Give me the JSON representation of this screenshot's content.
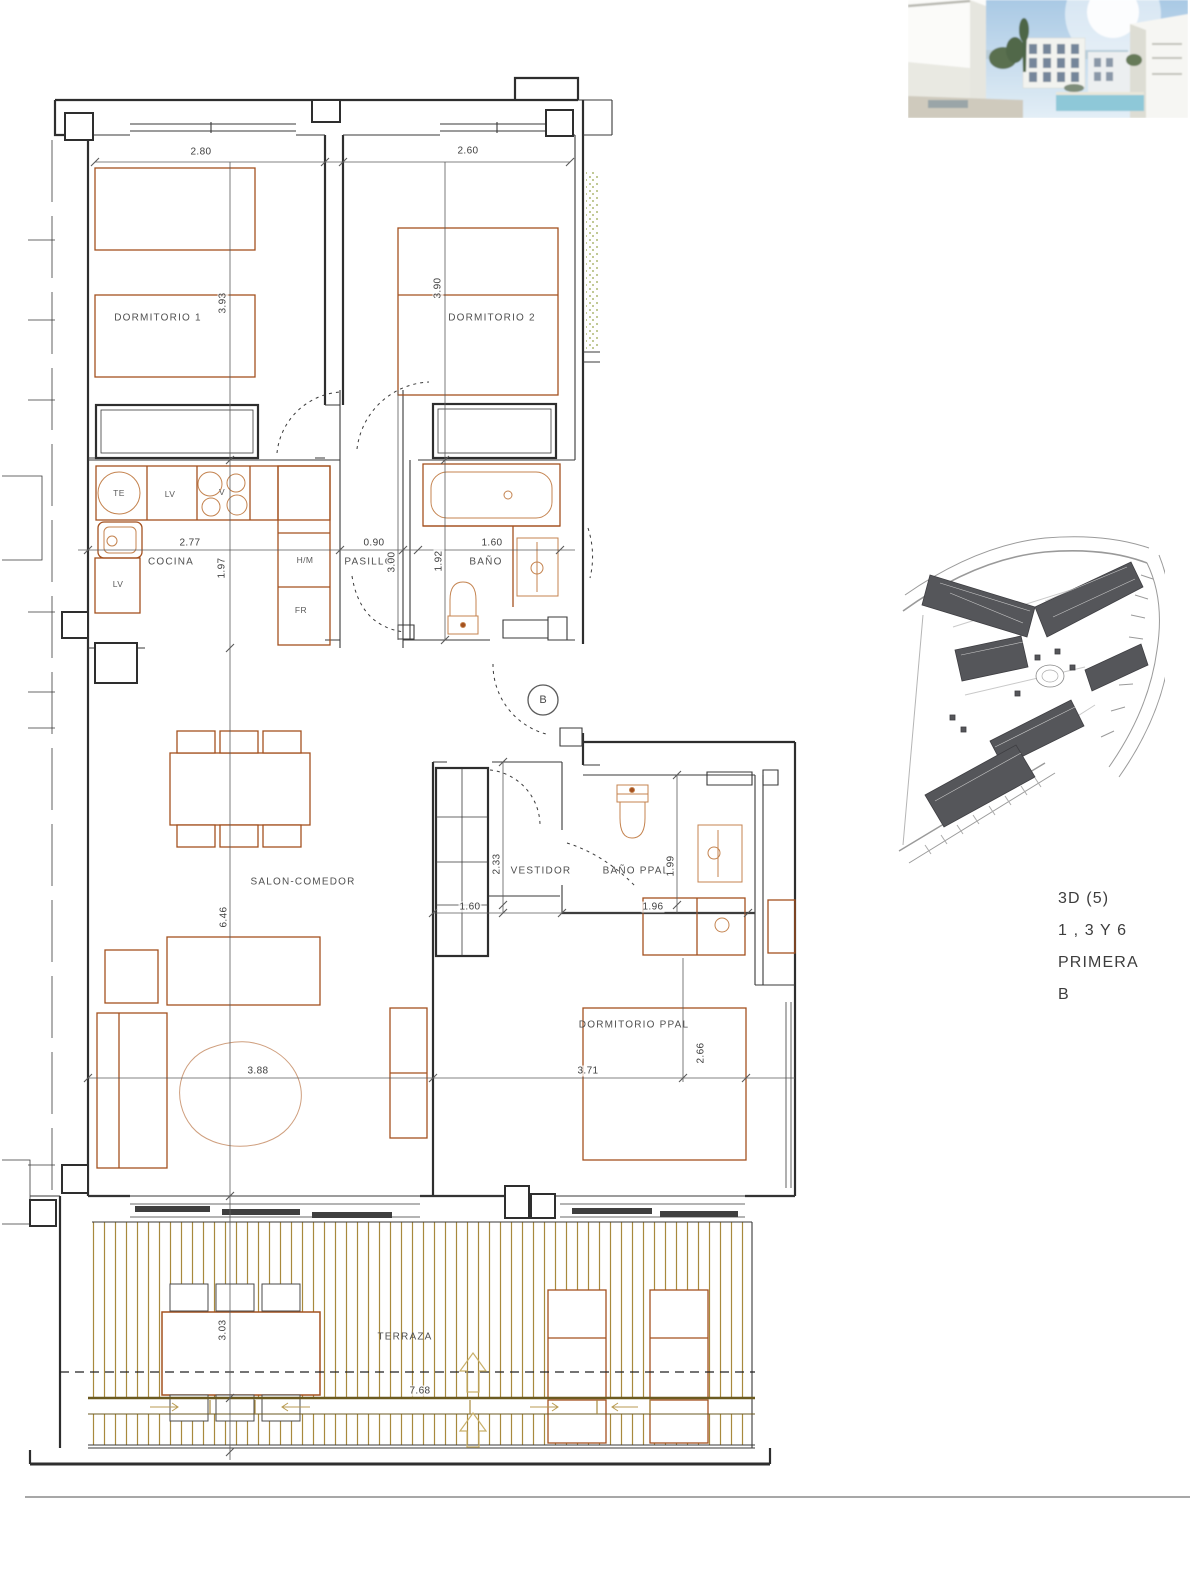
{
  "floor_plan": {
    "room_labels": {
      "dormitorio1": "DORMITORIO 1",
      "dormitorio2": "DORMITORIO 2",
      "cocina": "COCINA",
      "pasillo": "PASILLO",
      "bano": "BAÑO",
      "salon": "SALON-COMEDOR",
      "vestidor": "VESTIDOR",
      "bano_ppal": "BAÑO PPAL.",
      "dormitorio_ppal": "DORMITORIO PPAL",
      "terraza": "TERRAZA"
    },
    "appliance_labels": {
      "te": "TE",
      "lv_upper": "LV",
      "hob": "V",
      "lv_lower": "LV",
      "washer": "H/M",
      "fridge": "FR"
    },
    "entrance_marker": "B",
    "dimensions": {
      "dorm1_width": "2.80",
      "dorm2_width": "2.60",
      "dorm1_depth": "3.93",
      "dorm2_depth": "3.90",
      "cocina_width": "2.77",
      "cocina_depth": "1.97",
      "pasillo_width": "0.90",
      "pasillo_depth": "3.00",
      "bano_width": "1.60",
      "bano_depth": "1.92",
      "salon_depth": "6.46",
      "vestidor_depth": "2.33",
      "vestidor_width": "1.60",
      "bano_ppal_width": "1.96",
      "bano_ppal_depth": "1.99",
      "salon_width": "3.88",
      "dorm_ppal_width": "3.71",
      "dorm_ppal_depth": "2.66",
      "terraza_depth": "3.03",
      "terraza_width": "7.68"
    }
  },
  "info_block": {
    "line1": "3D (5)",
    "line2": "1 , 3 Y 6",
    "line3": "PRIMERA",
    "line4": "B"
  },
  "colors": {
    "wall": "#2e2e2e",
    "furniture": "#a4511f",
    "fixture": "#c4834f",
    "deck": "#a8893d",
    "dimension_text": "#4a4a4a",
    "stipple": "#96a44a"
  }
}
